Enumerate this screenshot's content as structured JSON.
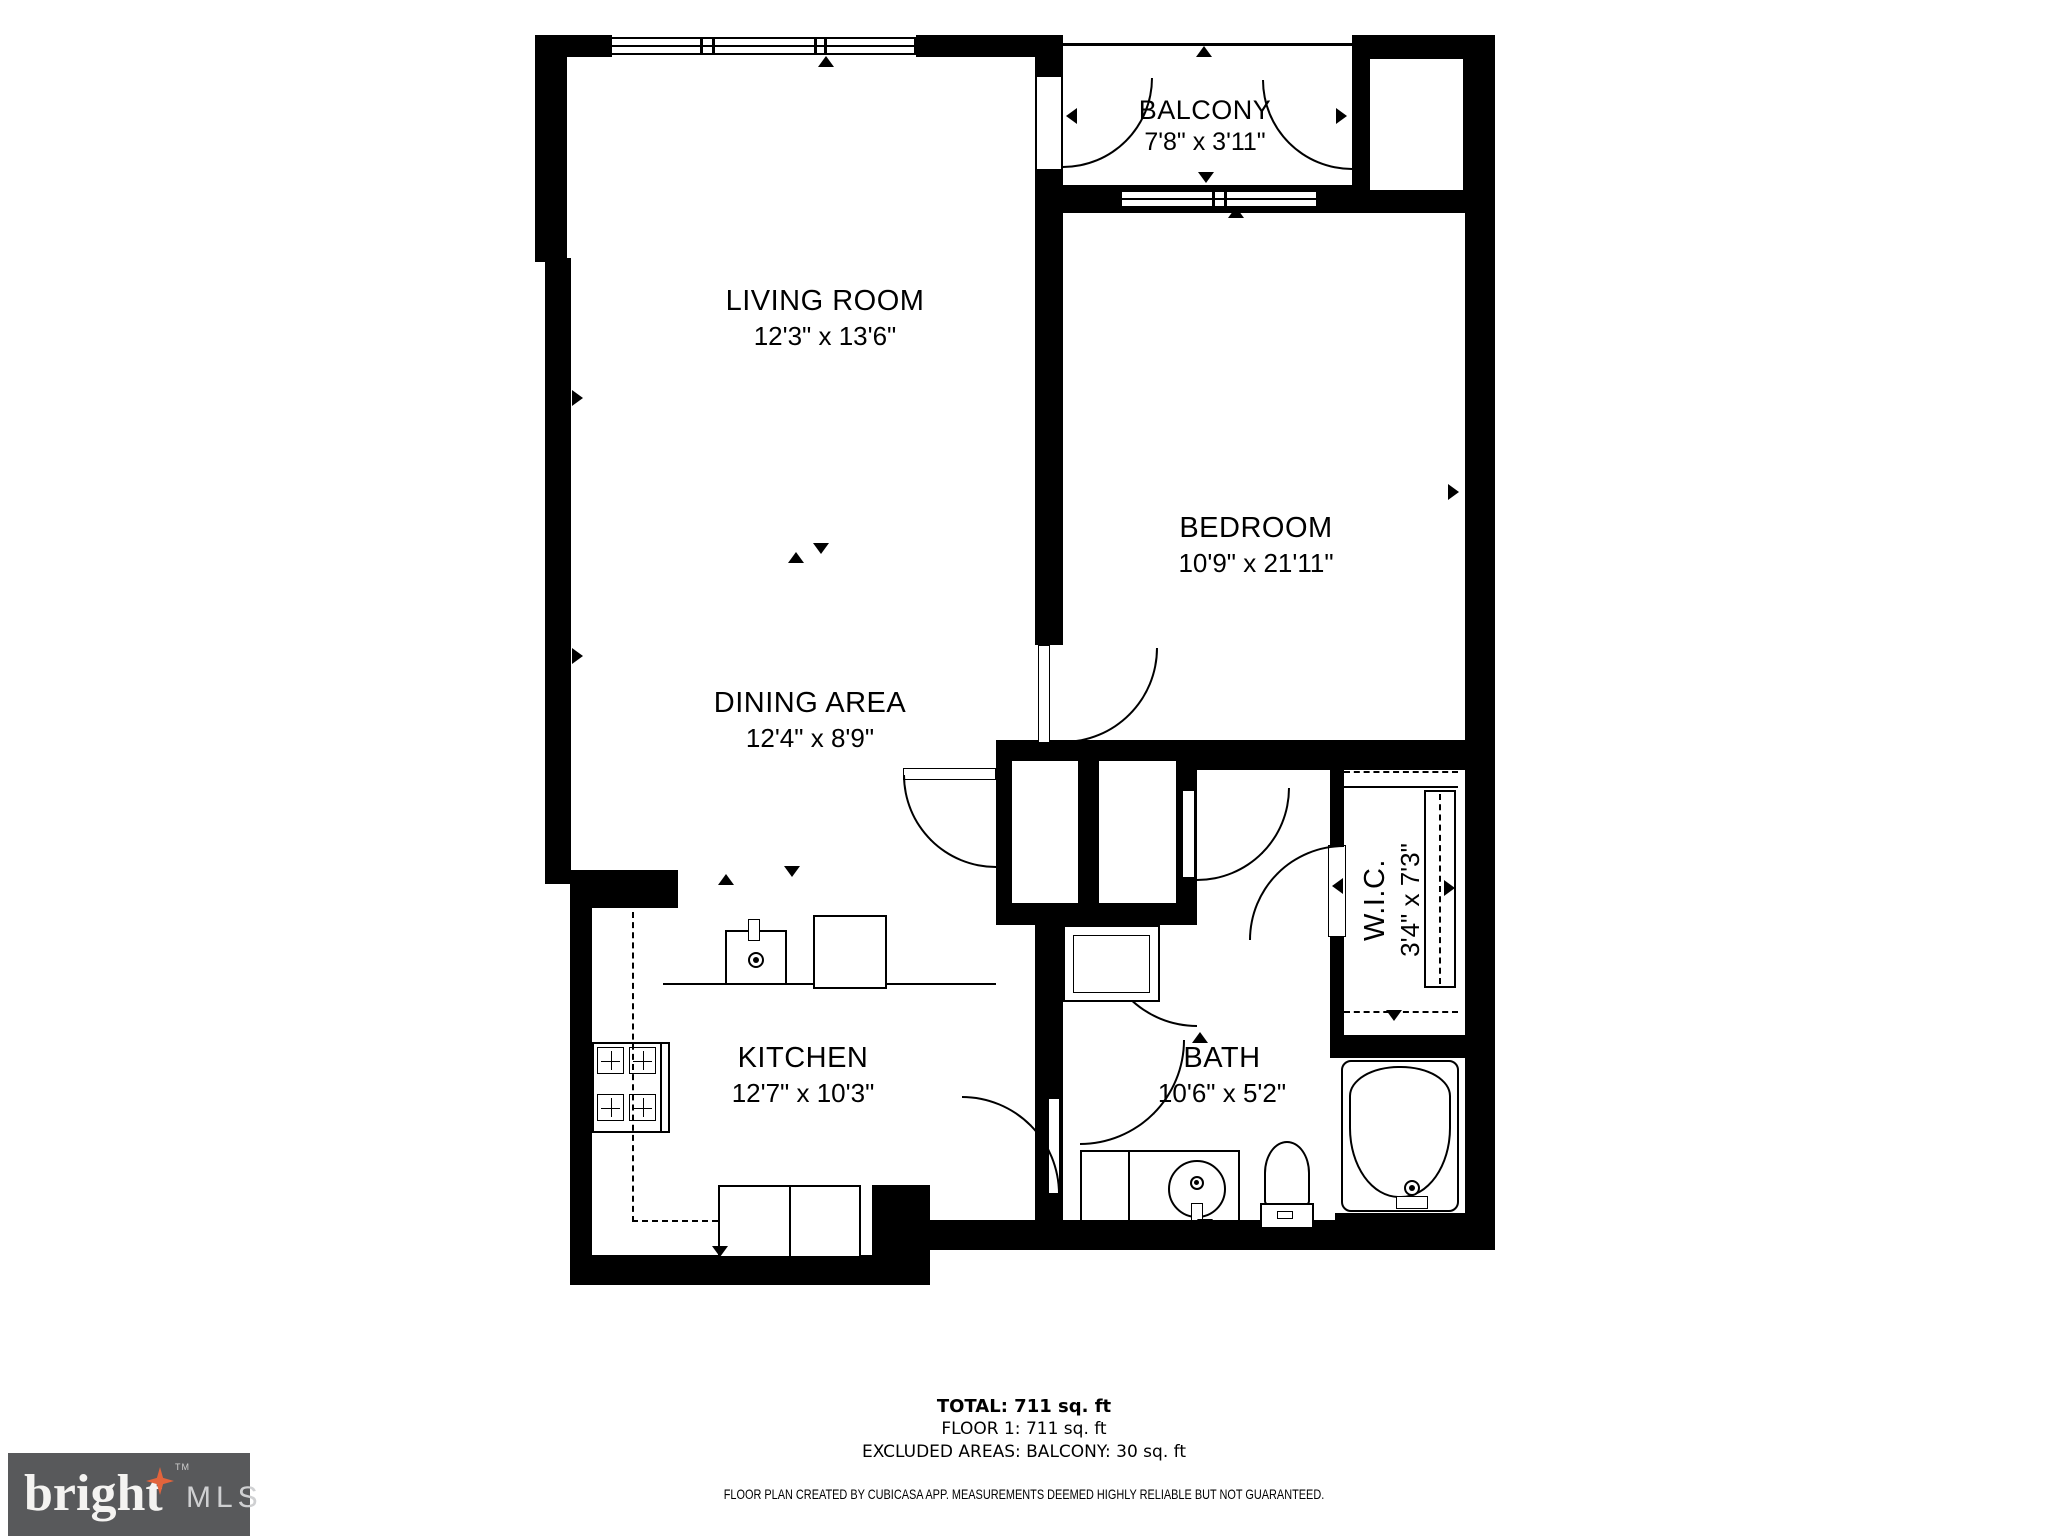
{
  "plan": {
    "rooms": [
      {
        "name": "LIVING ROOM",
        "dims": "12'3\" x 13'6\""
      },
      {
        "name": "BALCONY",
        "dims": "7'8\" x 3'11\""
      },
      {
        "name": "BEDROOM",
        "dims": "10'9\" x 21'11\""
      },
      {
        "name": "DINING AREA",
        "dims": "12'4\" x 8'9\""
      },
      {
        "name": "KITCHEN",
        "dims": "12'7\" x 10'3\""
      },
      {
        "name": "BATH",
        "dims": "10'6\" x 5'2\""
      },
      {
        "name": "W.I.C.",
        "dims": "3'4\" x 7'3\""
      }
    ]
  },
  "summary": {
    "total": "TOTAL: 711 sq. ft",
    "floor": "FLOOR 1: 711 sq. ft",
    "excluded": "EXCLUDED AREAS: BALCONY: 30 sq. ft"
  },
  "disclaimer": "FLOOR PLAN CREATED BY CUBICASA APP. MEASUREMENTS DEEMED HIGHLY RELIABLE BUT NOT GUARANTEED.",
  "logo": {
    "brand": "bright",
    "tm": "TM",
    "suffix": "MLS"
  },
  "colors": {
    "wall": "#000000",
    "logo_box": "#58595b",
    "logo_star": "#e2643c",
    "logo_mls": "#cfd0d2"
  }
}
